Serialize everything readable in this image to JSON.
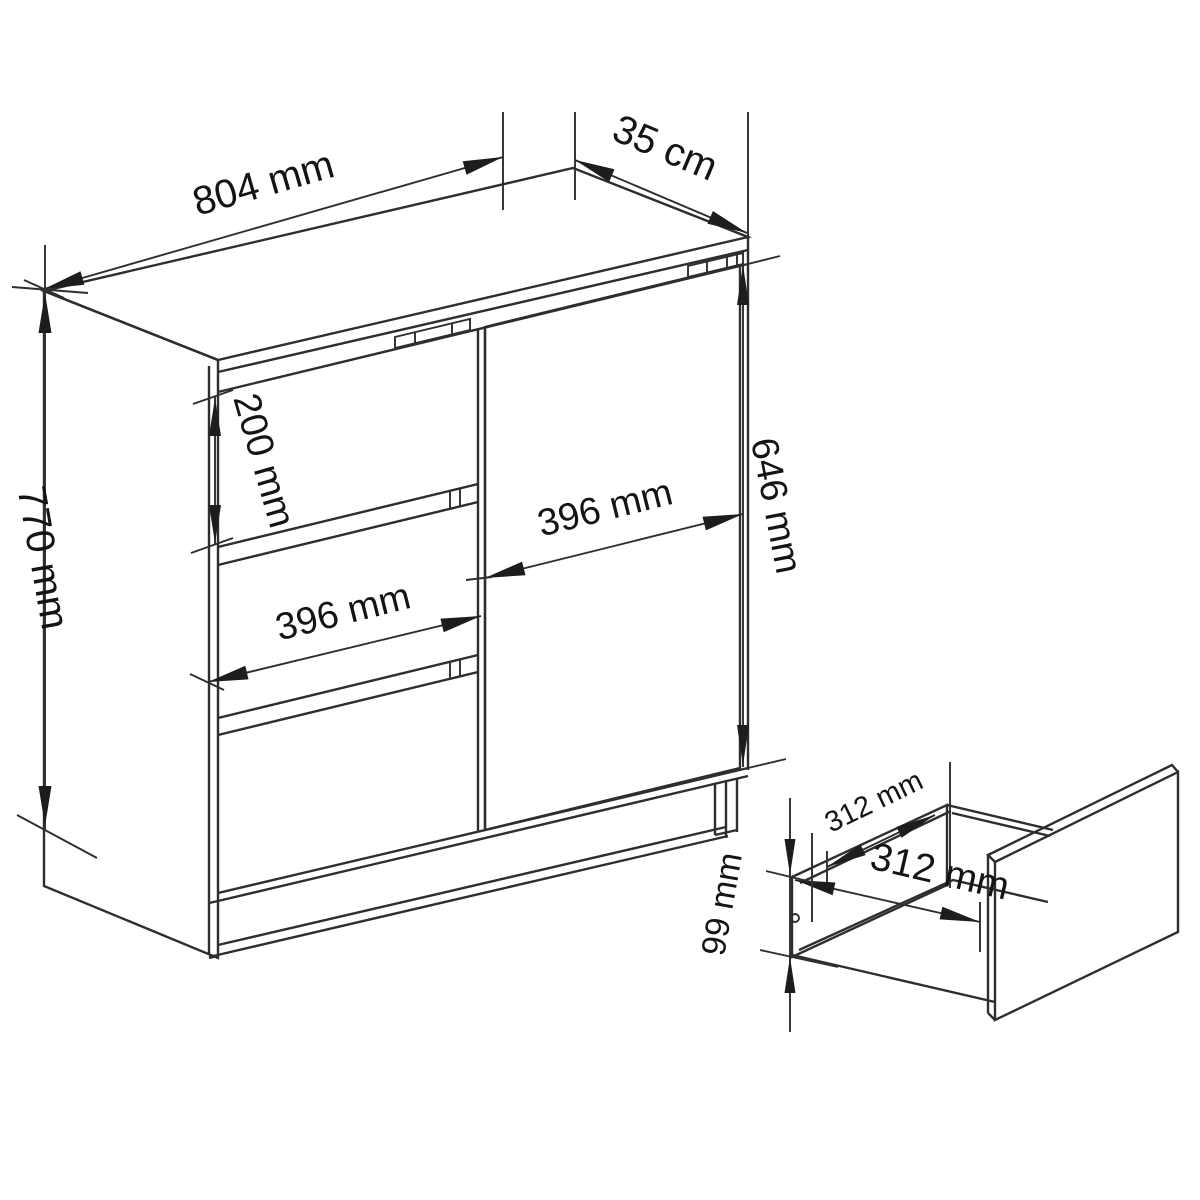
{
  "diagram": {
    "type": "furniture-technical-drawing",
    "product": "commode with 3 drawers and door",
    "colors": {
      "background": "#ffffff",
      "line": "#2e2e2e",
      "text": "#141414"
    },
    "cabinet": {
      "dimensions": {
        "width": "804 mm",
        "depth": "35 cm",
        "height": "770 mm",
        "top_drawer_height": "200 mm",
        "drawer_front_width": "396 mm",
        "door_width": "396 mm",
        "door_height": "646 mm"
      }
    },
    "drawer_detail": {
      "dimensions": {
        "inner_depth": "312 mm",
        "inner_width": "312 mm",
        "side_height": "99 mm"
      }
    }
  }
}
